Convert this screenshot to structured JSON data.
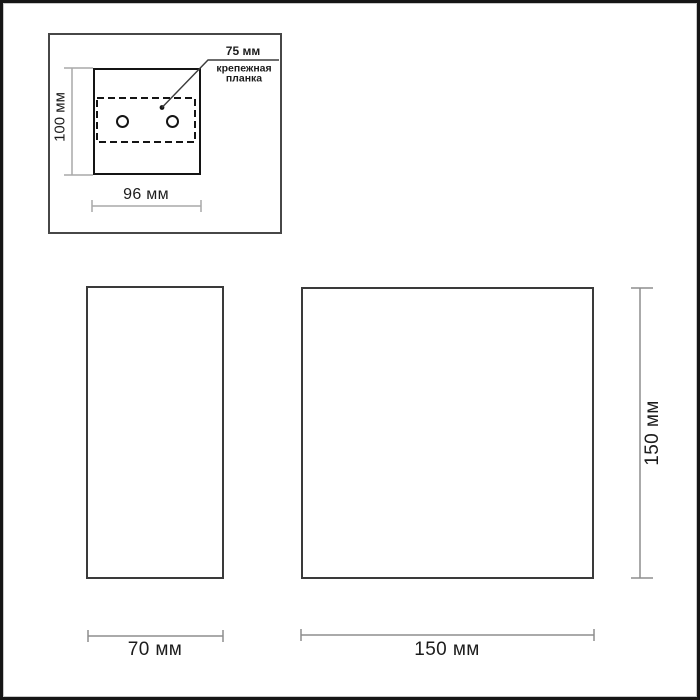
{
  "diagram": {
    "mounting_inset": {
      "height_dim": "100 мм",
      "width_dim": "96 мм",
      "hole_spacing_dim": "75 мм",
      "mounting_plate_note": "крепежная\nпланка"
    },
    "side_view": {
      "width_dim": "70 мм"
    },
    "front_view": {
      "width_dim": "150 мм",
      "height_dim": "150 мм"
    }
  },
  "colors": {
    "shape_stroke": "#141414",
    "view_stroke": "#3a3a3a",
    "dimension_stroke": "#8d8d8d",
    "inset_dimension_stroke": "#a8a8a8",
    "text": "#1c1c1c",
    "frame": "#161616",
    "background": "#ffffff"
  }
}
